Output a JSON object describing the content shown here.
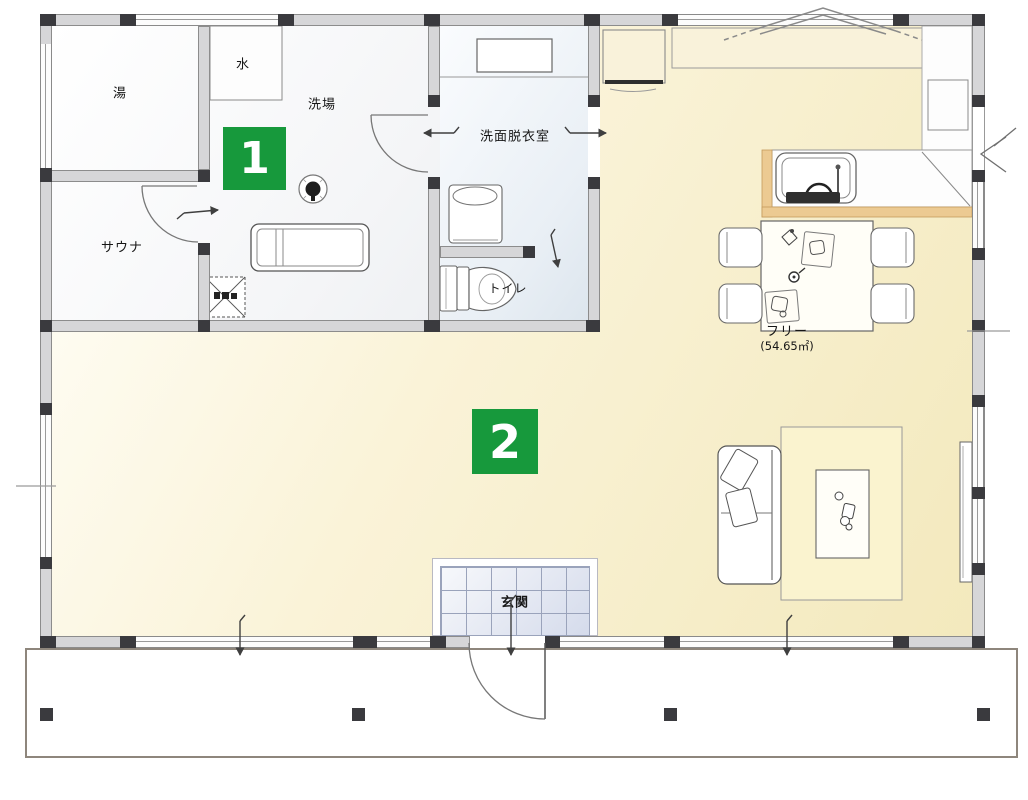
{
  "floorplan": {
    "rooms": {
      "bath": {
        "label": "湯"
      },
      "water": {
        "label": "水"
      },
      "wash_place": {
        "label": "洗場"
      },
      "sauna": {
        "label": "サウナ"
      },
      "washroom": {
        "label": "洗面脱衣室"
      },
      "toilet": {
        "label": "トイレ"
      },
      "free_space": {
        "label": "フリー",
        "area": "(54.65㎡)"
      },
      "entrance": {
        "label": "玄関"
      }
    },
    "badges": [
      {
        "number": "1"
      },
      {
        "number": "2"
      }
    ],
    "colors": {
      "badge_green": "#17993c",
      "floor_cream": "#f6edc5",
      "counter_tan": "#ecca92",
      "entrance_tile": "#dfe4f0",
      "wall_gray": "#d6d6d8"
    }
  }
}
